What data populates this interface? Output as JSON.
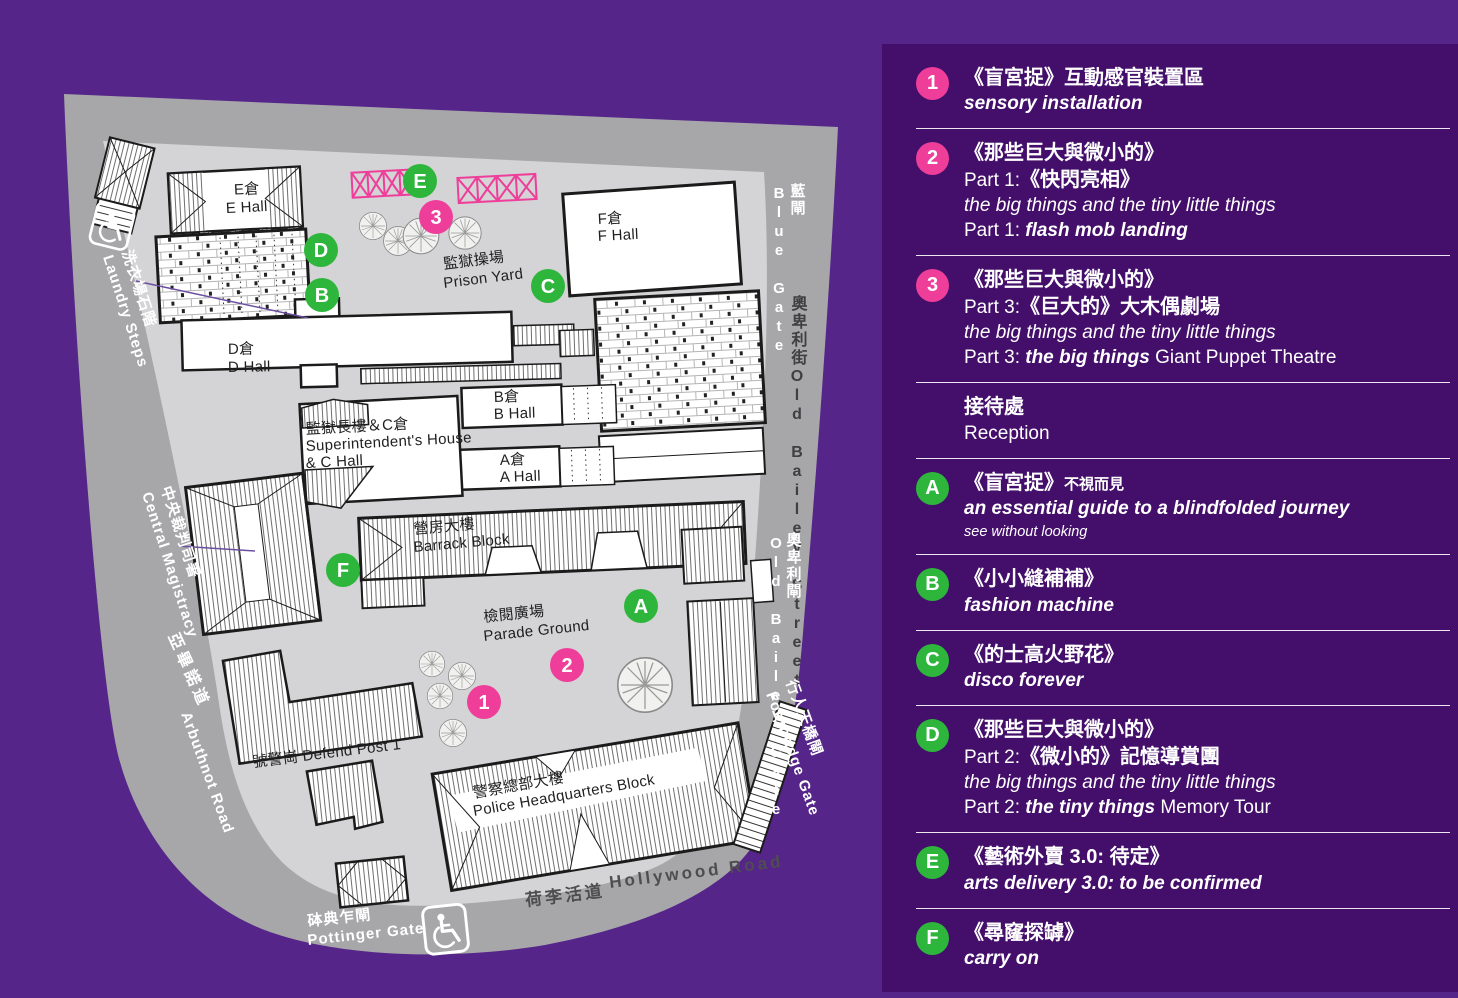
{
  "colors": {
    "background": "#55258A",
    "panel": "#440F6B",
    "pink": "#EE3E9A",
    "green": "#2EB63C",
    "road": "#A7A6A9",
    "compound": "#D4D3D5"
  },
  "legend": {
    "items": [
      {
        "marker": "1",
        "color": "pink",
        "lines": [
          [
            {
              "t": "《盲宮捉》互動感官裝置區",
              "s": "zh"
            }
          ],
          [
            {
              "t": "sensory installation",
              "s": "bi"
            }
          ]
        ]
      },
      {
        "marker": "2",
        "color": "pink",
        "lines": [
          [
            {
              "t": "《那些巨大與微小的》",
              "s": "zh"
            }
          ],
          [
            {
              "t": "Part 1:",
              "s": "reg"
            },
            {
              "t": "《快閃亮相》",
              "s": "zh"
            }
          ],
          [
            {
              "t": "the big things and the tiny little things",
              "s": "it"
            }
          ],
          [
            {
              "t": "Part 1: ",
              "s": "reg"
            },
            {
              "t": "flash mob landing",
              "s": "bi"
            }
          ]
        ]
      },
      {
        "marker": "3",
        "color": "pink",
        "lines": [
          [
            {
              "t": "《那些巨大與微小的》",
              "s": "zh"
            }
          ],
          [
            {
              "t": "Part 3:",
              "s": "reg"
            },
            {
              "t": "《巨大的》大木偶劇場",
              "s": "zh"
            }
          ],
          [
            {
              "t": "the big things and the tiny little things",
              "s": "it"
            }
          ],
          [
            {
              "t": "Part 3: ",
              "s": "reg"
            },
            {
              "t": "the big things",
              "s": "bi"
            },
            {
              "t": " Giant Puppet Theatre",
              "s": "reg"
            }
          ]
        ]
      },
      {
        "marker": null,
        "color": null,
        "lines": [
          [
            {
              "t": "接待處",
              "s": "zh"
            }
          ],
          [
            {
              "t": "Reception",
              "s": "reg"
            }
          ]
        ]
      },
      {
        "marker": "A",
        "color": "green",
        "lines": [
          [
            {
              "t": "《盲宮捉》",
              "s": "zh"
            },
            {
              "t": "不視而見",
              "s": "zhsm"
            }
          ],
          [
            {
              "t": "an essential guide to a blindfolded journey",
              "s": "bi"
            }
          ],
          [
            {
              "t": "see without looking",
              "s": "smit"
            }
          ]
        ]
      },
      {
        "marker": "B",
        "color": "green",
        "lines": [
          [
            {
              "t": "《小小縫補補》",
              "s": "zh"
            }
          ],
          [
            {
              "t": "fashion machine",
              "s": "bi"
            }
          ]
        ]
      },
      {
        "marker": "C",
        "color": "green",
        "lines": [
          [
            {
              "t": "《的士高火野花》",
              "s": "zh"
            }
          ],
          [
            {
              "t": "disco forever",
              "s": "bi"
            }
          ]
        ]
      },
      {
        "marker": "D",
        "color": "green",
        "lines": [
          [
            {
              "t": "《那些巨大與微小的》",
              "s": "zh"
            }
          ],
          [
            {
              "t": "Part 2:",
              "s": "reg"
            },
            {
              "t": "《微小的》記憶導賞團",
              "s": "zh"
            }
          ],
          [
            {
              "t": "the big things and the tiny little things",
              "s": "it"
            }
          ],
          [
            {
              "t": "Part 2: ",
              "s": "reg"
            },
            {
              "t": "the tiny things",
              "s": "bi"
            },
            {
              "t": " Memory Tour",
              "s": "reg"
            }
          ]
        ]
      },
      {
        "marker": "E",
        "color": "green",
        "lines": [
          [
            {
              "t": "《藝術外賣 3.0: 待定》",
              "s": "zh"
            }
          ],
          [
            {
              "t": "arts delivery 3.0: to be confirmed",
              "s": "bi"
            }
          ]
        ]
      },
      {
        "marker": "F",
        "color": "green",
        "lines": [
          [
            {
              "t": "《尋窿探罅》",
              "s": "zh"
            }
          ],
          [
            {
              "t": "carry on",
              "s": "bi"
            }
          ]
        ]
      }
    ]
  },
  "map": {
    "labels": [
      {
        "t": "E倉",
        "x": 247,
        "y": 194,
        "r": -3,
        "c": "bld mid"
      },
      {
        "t": "E Hall",
        "x": 247,
        "y": 212,
        "r": -3,
        "c": "bld mid"
      },
      {
        "t": "F倉",
        "x": 598,
        "y": 224,
        "r": -3,
        "c": "bld"
      },
      {
        "t": "F Hall",
        "x": 598,
        "y": 241,
        "r": -3,
        "c": "bld"
      },
      {
        "t": "D倉",
        "x": 228,
        "y": 354,
        "r": -1,
        "c": "bld"
      },
      {
        "t": "D Hall",
        "x": 228,
        "y": 372,
        "r": -1,
        "c": "bld"
      },
      {
        "t": "B倉",
        "x": 494,
        "y": 402,
        "r": -2,
        "c": "bld"
      },
      {
        "t": "B Hall",
        "x": 494,
        "y": 419,
        "r": -2,
        "c": "bld"
      },
      {
        "t": "監獄長樓＆C倉",
        "x": 306,
        "y": 434,
        "r": -3,
        "c": "bld"
      },
      {
        "t": "Superintendent's House",
        "x": 306,
        "y": 451,
        "r": -3,
        "c": "bld"
      },
      {
        "t": "& C Hall",
        "x": 306,
        "y": 468,
        "r": -3,
        "c": "bld"
      },
      {
        "t": "A倉",
        "x": 500,
        "y": 465,
        "r": -2,
        "c": "bld"
      },
      {
        "t": "A Hall",
        "x": 500,
        "y": 482,
        "r": -2,
        "c": "bld"
      },
      {
        "t": "監獄操場",
        "x": 444,
        "y": 269,
        "r": -7,
        "c": "bld"
      },
      {
        "t": "Prison Yard",
        "x": 444,
        "y": 288,
        "r": -7,
        "c": "bld"
      },
      {
        "t": "檢閱廣場",
        "x": 484,
        "y": 622,
        "r": -6,
        "c": "bld"
      },
      {
        "t": "Parade Ground",
        "x": 484,
        "y": 641,
        "r": -6,
        "c": "bld"
      },
      {
        "t": "營房大樓",
        "x": 414,
        "y": 534,
        "r": -5,
        "c": "bld"
      },
      {
        "t": "Barrack Block",
        "x": 414,
        "y": 552,
        "r": -5,
        "c": "bld"
      },
      {
        "t": "一號警崗 Defend Post 1",
        "x": 238,
        "y": 769,
        "r": -7,
        "c": "bld"
      },
      {
        "t": "警察總部大樓",
        "x": 474,
        "y": 798,
        "r": -10,
        "c": "bld"
      },
      {
        "t": "Police Headquarters Block",
        "x": 474,
        "y": 816,
        "r": -10,
        "c": "bld"
      },
      {
        "t": "荷李活道",
        "x": 526,
        "y": 906,
        "r": -7,
        "c": "road-dk"
      },
      {
        "t": "Hollywood Road",
        "x": 610,
        "y": 888,
        "r": -7,
        "c": "road-dk"
      },
      {
        "t": "砵典乍閘",
        "x": 308,
        "y": 926,
        "r": -6,
        "c": "road-wt"
      },
      {
        "t": "Pottinger Gate",
        "x": 308,
        "y": 945,
        "r": -6,
        "c": "road-wt"
      },
      {
        "t": "洗衣場石階",
        "x": 122,
        "y": 252,
        "r": 72,
        "c": "road-wt"
      },
      {
        "t": "Laundry Steps",
        "x": 103,
        "y": 257,
        "r": 72,
        "c": "road-wt"
      },
      {
        "t": "中央裁判司署",
        "x": 161,
        "y": 488,
        "r": 72,
        "c": "road-wt"
      },
      {
        "t": "Central Magistracy",
        "x": 142,
        "y": 494,
        "r": 72,
        "c": "road-wt"
      },
      {
        "t": "亞畢諾道",
        "x": 168,
        "y": 636,
        "r": 66,
        "c": "road-wt sp"
      },
      {
        "t": "Arbuthnot Road",
        "x": 181,
        "y": 714,
        "r": 70,
        "c": "road-wt"
      },
      {
        "t": "藍閘",
        "x": 797,
        "y": 183,
        "r": 0,
        "c": "road-wt v"
      },
      {
        "t": "Blue Gate",
        "x": 779,
        "y": 185,
        "r": 0,
        "c": "road-wt v"
      },
      {
        "t": "奧卑利街",
        "x": 797,
        "y": 295,
        "r": 0,
        "c": "road-dkv v"
      },
      {
        "t": "Old Bailey Street",
        "x": 797,
        "y": 368,
        "r": 0,
        "c": "road-dkv v"
      },
      {
        "t": "奧卑利閘",
        "x": 793,
        "y": 532,
        "r": 0,
        "c": "road-wt v"
      },
      {
        "t": "Old Bailey Gate",
        "x": 776,
        "y": 535,
        "r": 0,
        "c": "road-wt v"
      },
      {
        "t": "行人天橋閘",
        "x": 786,
        "y": 682,
        "r": 70,
        "c": "road-wt"
      },
      {
        "t": "Footbridge Gate",
        "x": 766,
        "y": 694,
        "r": 70,
        "c": "road-wt"
      }
    ],
    "markers": [
      {
        "t": "E",
        "x": 420,
        "y": 181,
        "c": "green"
      },
      {
        "t": "3",
        "x": 436,
        "y": 217,
        "c": "pink"
      },
      {
        "t": "D",
        "x": 321,
        "y": 250,
        "c": "green"
      },
      {
        "t": "B",
        "x": 322,
        "y": 295,
        "c": "green"
      },
      {
        "t": "C",
        "x": 548,
        "y": 286,
        "c": "green"
      },
      {
        "t": "F",
        "x": 343,
        "y": 570,
        "c": "green"
      },
      {
        "t": "A",
        "x": 641,
        "y": 606,
        "c": "green"
      },
      {
        "t": "2",
        "x": 567,
        "y": 665,
        "c": "pink"
      },
      {
        "t": "1",
        "x": 484,
        "y": 702,
        "c": "pink"
      }
    ]
  }
}
